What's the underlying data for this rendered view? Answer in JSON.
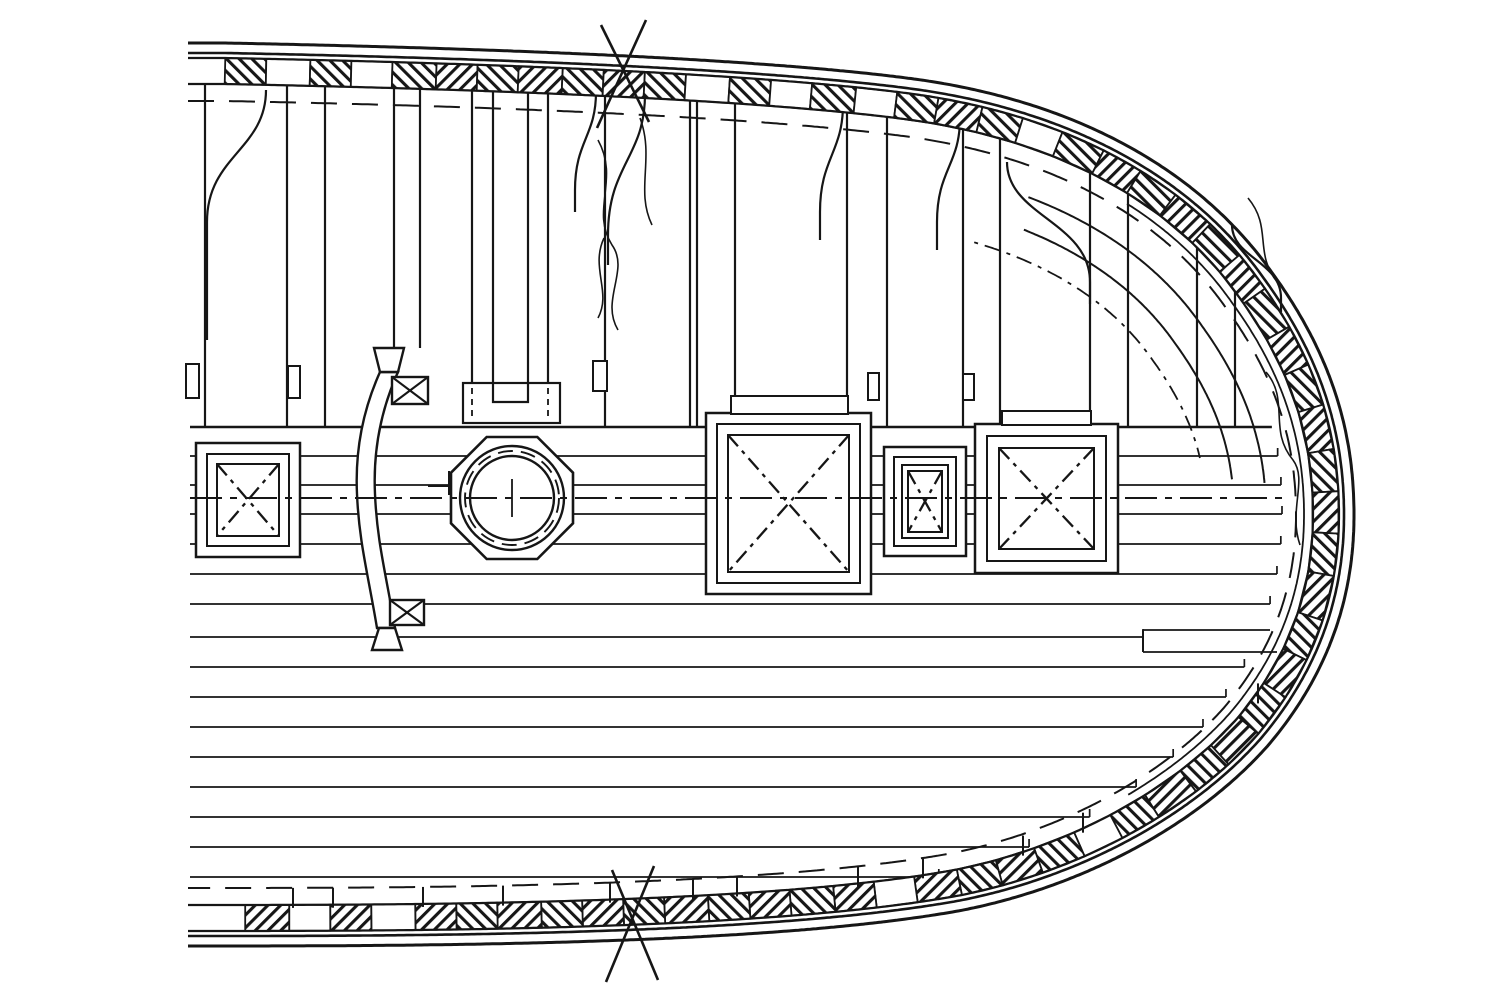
{
  "meta": {
    "width": 1500,
    "height": 1001,
    "kind": "ship-deck-construction-plan"
  },
  "colors": {
    "ink": "#161616",
    "paper": "#ffffff"
  },
  "band": {
    "center": "M225,71 C480,76 750,86 905,106 C1060,126 1180,190 1250,290 C1308,370 1326,442 1326,515 C1326,592 1302,662 1247,727 C1175,808 1060,864 950,884 C760,917 420,918 210,918",
    "block": 42,
    "halfw": 13,
    "whites": [
      1,
      3,
      11,
      13,
      15,
      19
    ],
    "whitesFromEnd": [
      2,
      4,
      16,
      21
    ]
  },
  "offsets": {
    "hullInner": -18,
    "hullOuter": -28,
    "sheer": 30,
    "margin": 22,
    "arcs": [
      60,
      92
    ],
    "deepDash": 120
  },
  "deck": {
    "deckLineY": 427,
    "centerlineY": 498,
    "plankYs": [
      456,
      485,
      514,
      544,
      574,
      604,
      637,
      667,
      697,
      727,
      757,
      787,
      817,
      847,
      877
    ],
    "plankEndInset": 44,
    "joggle": {
      "x": 1143,
      "y1": 630,
      "y2": 652,
      "xe1": 1270,
      "xe2": 1277
    }
  },
  "beams": [
    {
      "x": 205
    },
    {
      "x": 287
    },
    {
      "x": 325
    },
    {
      "x": 394,
      "to": 348
    },
    {
      "x": 420,
      "to": 348
    },
    {
      "x": 605
    },
    {
      "x": 690
    },
    {
      "x": 697
    },
    {
      "x": 735
    },
    {
      "x": 847
    },
    {
      "x": 887
    },
    {
      "x": 963
    },
    {
      "x": 1000
    },
    {
      "x": 1090
    },
    {
      "x": 1128
    },
    {
      "x": 1197
    },
    {
      "x": 1235
    }
  ],
  "mast": {
    "strips": [
      472,
      493,
      528,
      548
    ],
    "stripBottom": 383,
    "slot": {
      "x1": 493,
      "x2": 528,
      "y": 402
    },
    "chock": [
      463,
      383,
      97,
      40
    ],
    "dashedX": [
      472,
      548
    ],
    "dashedY": [
      388,
      420
    ]
  },
  "tabs": [
    [
      186,
      364,
      13,
      34
    ],
    [
      288,
      366,
      12,
      32
    ],
    [
      593,
      361,
      14,
      30
    ],
    [
      868,
      373,
      11,
      27
    ],
    [
      963,
      374,
      11,
      26
    ]
  ],
  "knees": [
    [
      266,
      90,
      207,
      222,
      118
    ],
    [
      596,
      92,
      575,
      190,
      22
    ],
    [
      645,
      94,
      608,
      235,
      30
    ],
    [
      843,
      104,
      820,
      212,
      28
    ],
    [
      960,
      118,
      937,
      222,
      28
    ],
    [
      1007,
      162,
      1090,
      282,
      22
    ],
    [
      1232,
      225,
      1281,
      298,
      14
    ]
  ],
  "octagon": {
    "cx": 512,
    "cy": 498,
    "r": 66,
    "circles": [
      52,
      47,
      42
    ],
    "tick": [
      512,
      479,
      512,
      517
    ],
    "sideTick": [
      449,
      471,
      449,
      495
    ],
    "link": [
      428,
      486,
      452,
      486
    ]
  },
  "pipe": {
    "body": "M380,372 C362,412 355,452 357,494 C359,542 368,574 377,628 L395,628 C386,574 377,542 375,494 C373,452 380,412 398,372 Z",
    "topTrap": "M374,348 L404,348 L398,372 L380,372 Z",
    "botTrap": "M379,628 L395,628 L402,650 L372,650 Z",
    "boxTop": [
      392,
      377,
      36,
      27
    ],
    "boxBot": [
      390,
      600,
      34,
      25
    ]
  },
  "hatches": [
    {
      "name": "hatch-left-small",
      "rects": [
        [
          196,
          443,
          104,
          114
        ],
        [
          207,
          454,
          82,
          92
        ],
        [
          217,
          464,
          62,
          72
        ]
      ],
      "xIdx": 2
    },
    {
      "name": "hatch-main-large",
      "rects": [
        [
          706,
          413,
          165,
          181
        ],
        [
          717,
          424,
          143,
          159
        ],
        [
          728,
          435,
          121,
          137
        ]
      ],
      "lip": [
        731,
        396,
        117,
        18
      ],
      "xIdx": 2
    },
    {
      "name": "hatch-mid-small",
      "rects": [
        [
          884,
          447,
          82,
          109
        ],
        [
          894,
          457,
          62,
          89
        ],
        [
          902,
          465,
          46,
          73
        ],
        [
          908,
          471,
          34,
          61
        ]
      ],
      "xIdx": 3
    },
    {
      "name": "hatch-right-medium",
      "rects": [
        [
          975,
          424,
          143,
          149
        ],
        [
          987,
          436,
          119,
          125
        ],
        [
          999,
          448,
          95,
          101
        ]
      ],
      "lip": [
        1002,
        411,
        89,
        14
      ],
      "xIdx": 2
    }
  ],
  "stubs": [
    293,
    333,
    423,
    503,
    610,
    693,
    737,
    858,
    923,
    1023,
    1083,
    1258
  ],
  "breaks": {
    "top": [
      [
        601,
        25,
        649,
        122
      ],
      [
        646,
        20,
        597,
        128
      ]
    ],
    "bottom": [
      [
        612,
        870,
        658,
        980
      ],
      [
        654,
        866,
        606,
        982
      ]
    ]
  },
  "scribbles": [
    "M598,140 C620,180 590,210 612,245 C630,270 600,300 618,330",
    "M640,118 C655,158 635,190 652,225",
    "M1266,372 C1290,400 1268,430 1293,460 C1308,480 1288,510 1300,545",
    "M1248,198 C1273,228 1253,253 1278,283",
    "M604,238 C590,268 612,292 598,318"
  ]
}
